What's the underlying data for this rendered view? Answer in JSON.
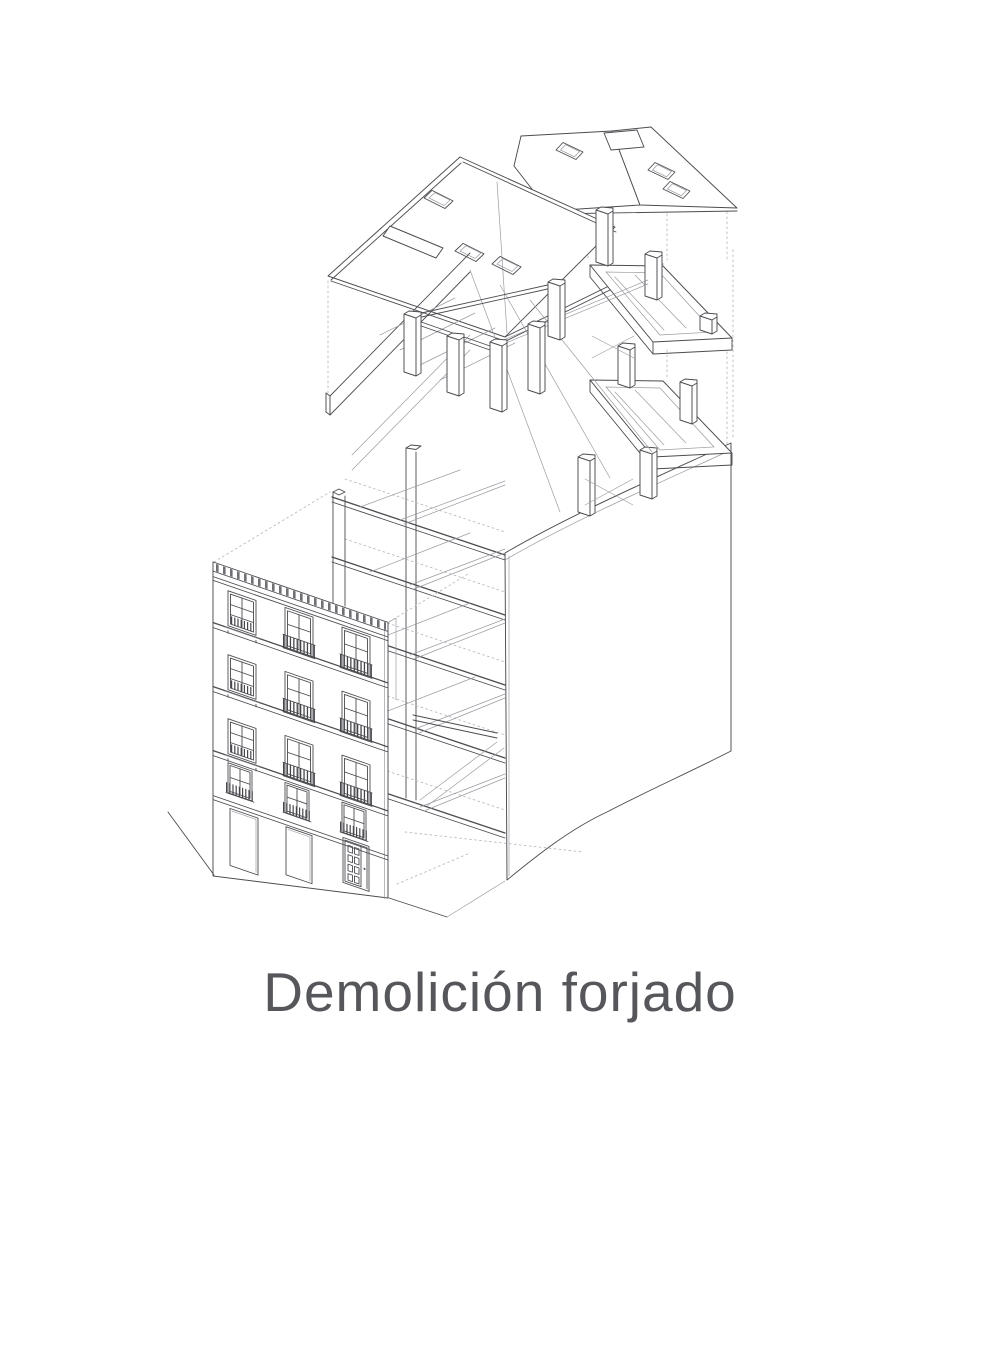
{
  "page": {
    "background_color": "#ffffff"
  },
  "drawing": {
    "caption": "Demolición forjado",
    "caption_color": "#56575b",
    "line_color": "#4b4c50",
    "light_line_color": "#9b9ca2",
    "dashed_line_color": "#babbbf",
    "dark_detail_color": "#46474b",
    "paper_color": "#ffffff",
    "alt": "Exploded axonometric line drawing of a townhouse: lifted roof planes with skylights, a timber post-and-beam attic structure, stacked open floor slabs marked for demolition, a rear party wall, and a street facade with balconied windows above a ground floor with two openings and a panelled door."
  }
}
